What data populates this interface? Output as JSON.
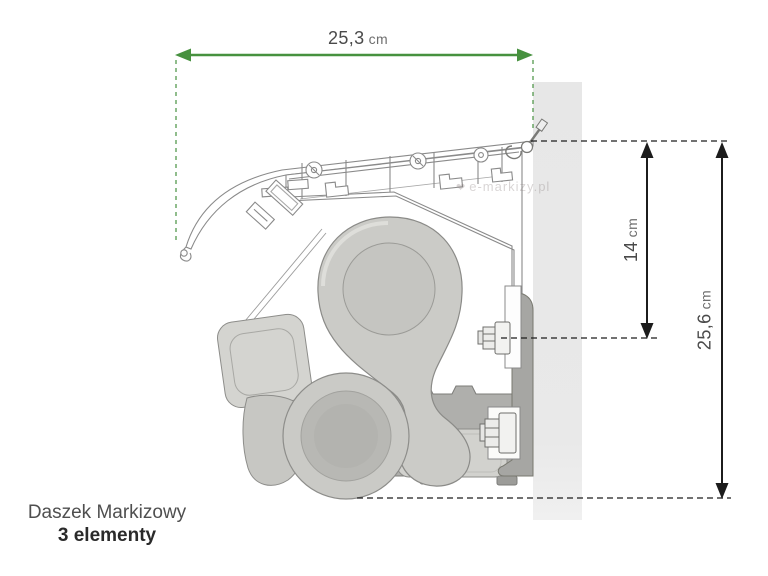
{
  "dimensions": {
    "width": {
      "value": "25,3",
      "unit": "cm"
    },
    "drop": {
      "value": "14",
      "unit": "cm"
    },
    "total": {
      "value": "25,6",
      "unit": "cm"
    }
  },
  "caption": {
    "title": "Daszek Markizowy",
    "subtitle": "3 elementy"
  },
  "watermark": {
    "logo": "heart-icon",
    "text": "e-markizy.pl"
  },
  "colors": {
    "dimension_green": "#47913f",
    "dimension_black": "#1c1c1c",
    "wall_gray": "#e9e9e9",
    "label_text": "#4a4a4a",
    "caption_title": "#4f4f4f",
    "caption_subtitle": "#2a2a2a"
  }
}
